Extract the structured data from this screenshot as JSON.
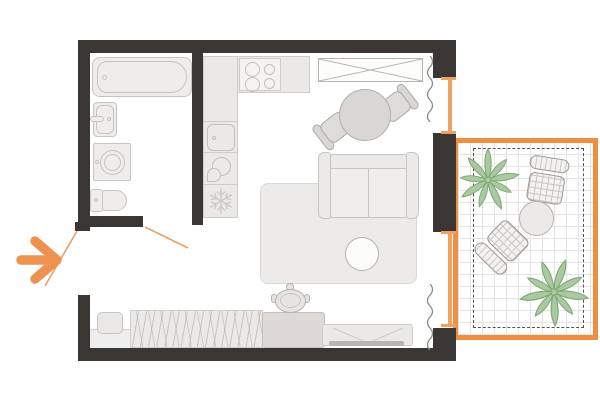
{
  "palette": {
    "background": "#ffffff",
    "wall": "#393634",
    "accent_orange": "#ee9251",
    "balcony_border_orange": "#ef8e3e",
    "window_frame_orange": "#efa15f",
    "door_swing_orange": "#e6a06a",
    "furniture_fill": "#eeedec",
    "furniture_border": "#c7c5c2",
    "counter_fill": "#eae9e7",
    "gray_furniture_fill": "#d9d7d5",
    "gray_furniture_border": "#aba9a6",
    "dark_accent_gray": "#b7b4b1",
    "rug_fill": "#ecebea",
    "cabinet_fill": "#dcd9d6",
    "plant_fill": "#a9c9a0",
    "plant_stroke": "#7da675",
    "wicker_outline": "#9b9894",
    "curtain_gray": "#8d8b88",
    "grid_line": "#e6e4e2",
    "dashed_line": "#56534f"
  },
  "icons": {
    "entrance_arrow": "thick orange right-pointing arrow",
    "door_swing": "thin orange diagonal line",
    "fridge_freezer": "snowflake glyph",
    "stove": "four burner circles",
    "kettle": "circle with teardrop spout",
    "wardrobe": "rectangle with X cross",
    "curtain": "vertical squiggle line",
    "washing_machine": "square with round drum",
    "tile_grid": "square grid flooring",
    "plant": "leafy green cluster"
  },
  "floor_plan": {
    "type": "studio-apartment",
    "rooms": [
      {
        "name": "bathroom",
        "furniture": [
          "bathtub",
          "sink",
          "washing-machine",
          "toilet"
        ]
      },
      {
        "name": "kitchen",
        "furniture": [
          "l-shaped-counter",
          "stove",
          "kitchen-sink",
          "kettle",
          "fridge-freezer"
        ]
      },
      {
        "name": "living-sleeping-area",
        "furniture": [
          "wardrobe",
          "dining-table",
          "dining-chair",
          "dining-chair",
          "sofa",
          "rug",
          "coffee-table",
          "bed",
          "pillow",
          "blanket",
          "cabinet",
          "pot",
          "bench"
        ]
      },
      {
        "name": "balcony",
        "furniture": [
          "plant",
          "wicker-chair",
          "round-table",
          "wicker-chair",
          "plant"
        ]
      }
    ],
    "openings": [
      "entrance-door",
      "bathroom-door",
      "balcony-door",
      "window"
    ]
  }
}
